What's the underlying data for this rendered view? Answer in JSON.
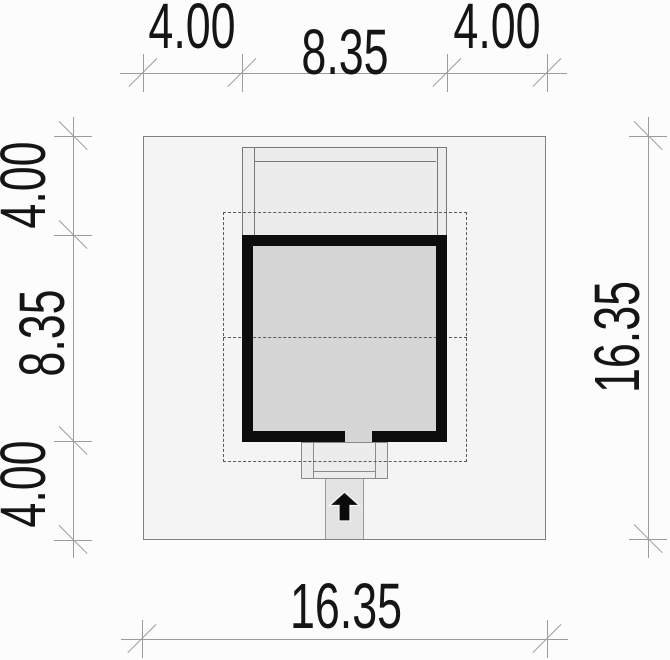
{
  "drawing": {
    "type": "architectural site plan",
    "dimensions": {
      "top": {
        "left": "4.00",
        "middle": "8.35",
        "right": "4.00"
      },
      "left": {
        "top": "4.00",
        "middle": "8.35",
        "bottom": "4.00"
      },
      "right": {
        "total": "16.35"
      },
      "bottom": {
        "total": "16.35"
      }
    },
    "icons": {
      "entrance_arrow": "up-arrow"
    },
    "colors": {
      "wall": "#0d0d0d",
      "lot_fill": "#f4f4f4",
      "roof_fill": "#ececec",
      "interior_fill": "#d6d6d6",
      "path_fill": "#e3e3e3",
      "dimension_line": "#9c9c9c"
    }
  }
}
